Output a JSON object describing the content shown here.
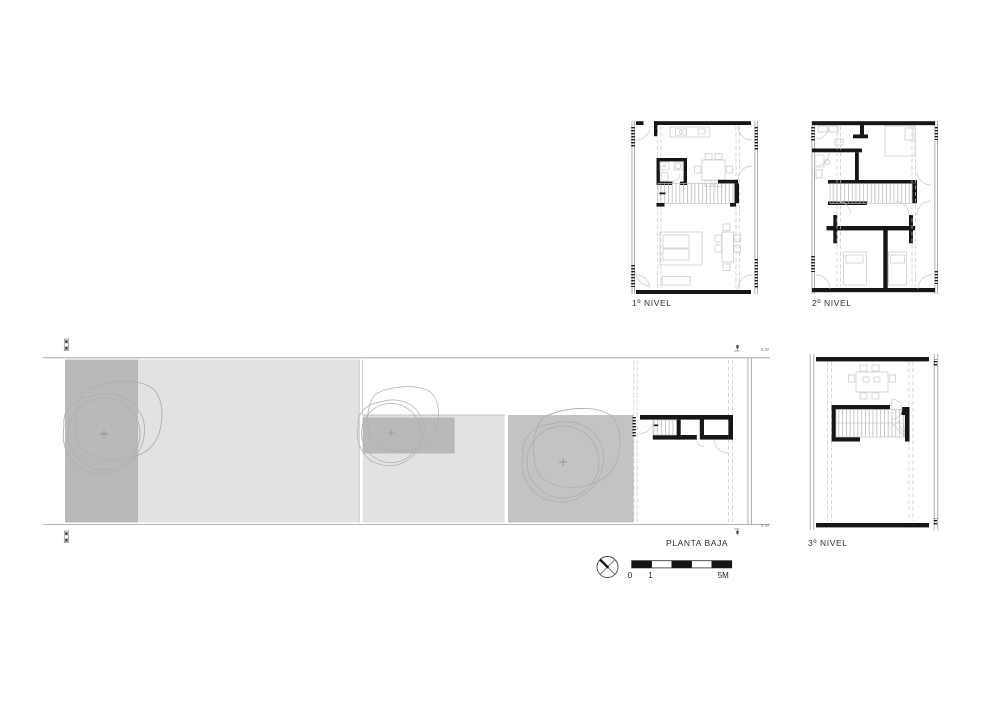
{
  "document": {
    "kind": "architectural floor plan sheet",
    "background_color": "#ffffff",
    "wall_ink_color": "#161616",
    "light_line_color": "#c7c7c7",
    "fills": {
      "dark_gray": "#b9b9b9",
      "light_gray": "#e2e2e2",
      "garden_gray": "#c3c3c3"
    }
  },
  "plans": {
    "nivel1": {
      "label": "1º NIVEL"
    },
    "nivel2": {
      "label": "2º NIVEL"
    },
    "nivel3": {
      "label": "3º NIVEL"
    },
    "planta_baja": {
      "label": "PLANTA BAJA",
      "boundary_marks": {
        "top_right": "E.M",
        "bottom_right": "E.M"
      }
    }
  },
  "scale_bar": {
    "labels": {
      "start": "0",
      "one": "1",
      "end": "5M"
    },
    "segments_m": [
      1,
      1,
      1,
      1,
      1
    ]
  },
  "north_arrow": {
    "icon": "compass-crossed-circle"
  }
}
